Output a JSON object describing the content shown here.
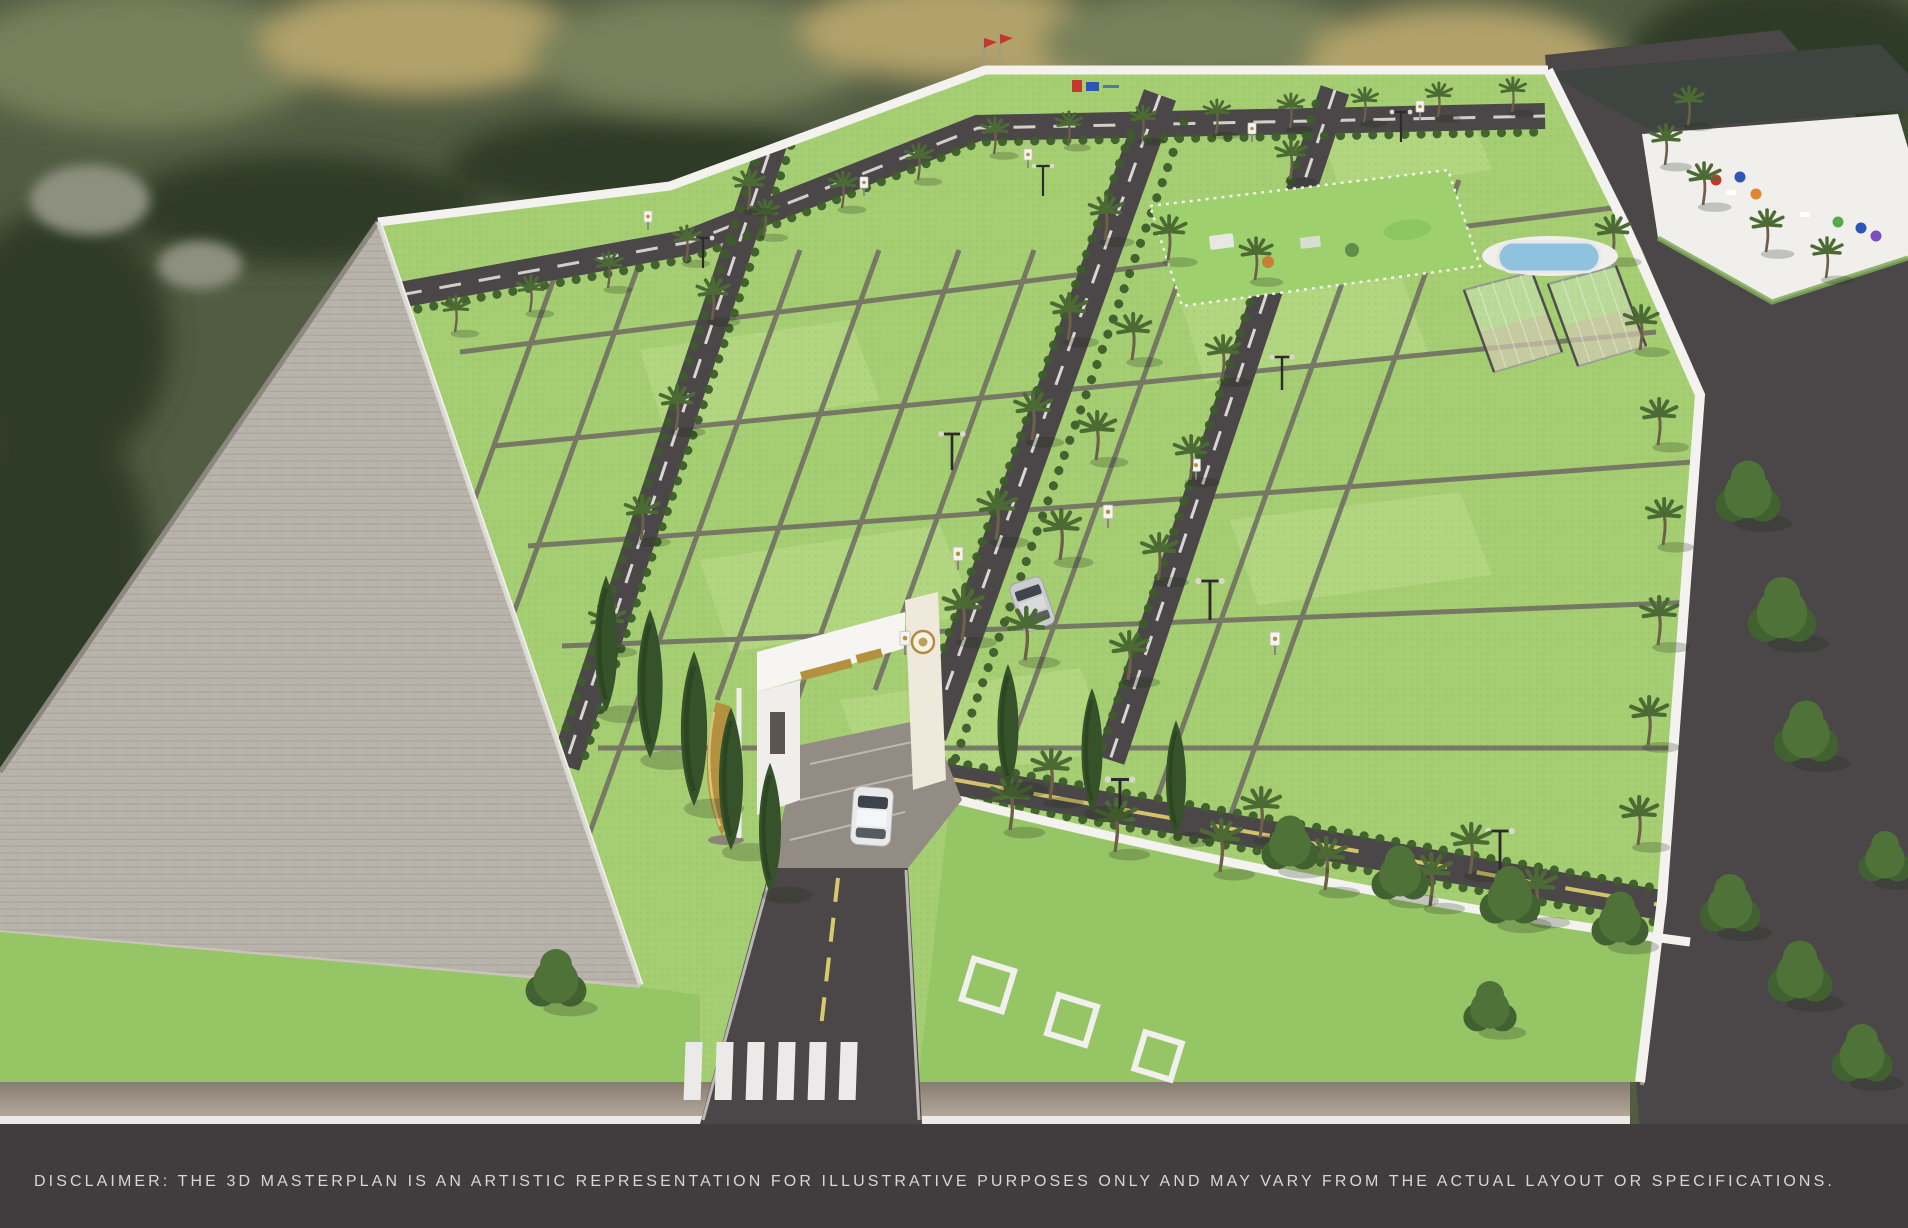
{
  "scene": {
    "description": "Aerial 3D masterplan render of a gated plotted land development with entrance arch, internal roads, green plots, sports courts and amenity deck",
    "disclaimer_text": "DISCLAIMER: THE 3D MASTERPLAN IS AN ARTISTIC REPRESENTATION FOR ILLUSTRATIVE PURPOSES ONLY AND MAY VARY FROM THE ACTUAL LAYOUT OR SPECIFICATIONS."
  },
  "colors": {
    "land_base": "#515c42",
    "land_olive": "#77815a",
    "land_gold": "#b2a26b",
    "forest_dark": "#2d3a28",
    "rock_gray": "#8e907f",
    "paved_gray": "#b8b3ab",
    "paved_line": "#a39e96",
    "wall_white": "#f3f2ef",
    "plot_green": "#a5ce73",
    "plot_green_light": "#bede8c",
    "lawn_green": "#96c566",
    "hedge_green": "#3f5c2d",
    "road_dark": "#4b4748",
    "road_bottom": "#413d3e",
    "line_white": "#e9e7e3",
    "line_yellow": "#d9c96c",
    "palm_green": "#4c6a33",
    "palm_trunk": "#6c6148",
    "cypress_green": "#36522a",
    "tree_green": "#4e7238",
    "pool_blue": "#8ec2de",
    "deck_white": "#f0efec",
    "roof_dark": "#3e4440",
    "gold": "#b3913f",
    "umb_red": "#c5392c",
    "umb_blue": "#2e55b5",
    "umb_orange": "#e0862f",
    "umb_green": "#58a848",
    "umb_purple": "#7b4fc0",
    "text_light": "#d9d6d3"
  }
}
